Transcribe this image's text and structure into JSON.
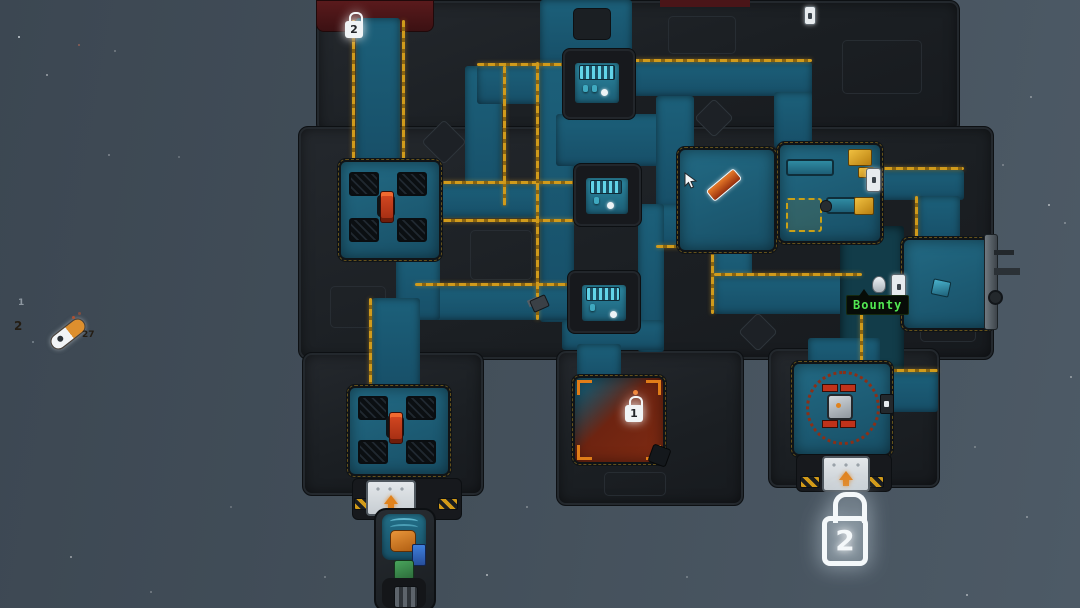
{
  "hud": {
    "bounty_label": "Bounty",
    "pod_top_label": "1",
    "pod_left_label": "2",
    "pod_right_label": "27"
  },
  "locks": {
    "top_door_level": "2",
    "alarm_room_level": "1",
    "airlock_level": "2"
  },
  "colors": {
    "space_left": "#3c4752",
    "space_right": "#4d5a66",
    "hull": "#1d2125",
    "floor_teal": "#1c607a",
    "floor_dim": "#123c49",
    "conduit_yellow": "#d09a1b",
    "alarm_red": "#7e2a12",
    "turret_red": "#c23b1d",
    "bounty_green": "#52e852",
    "lock_white": "#f0f4f6",
    "dock_arrow_orange": "#e0821c"
  }
}
